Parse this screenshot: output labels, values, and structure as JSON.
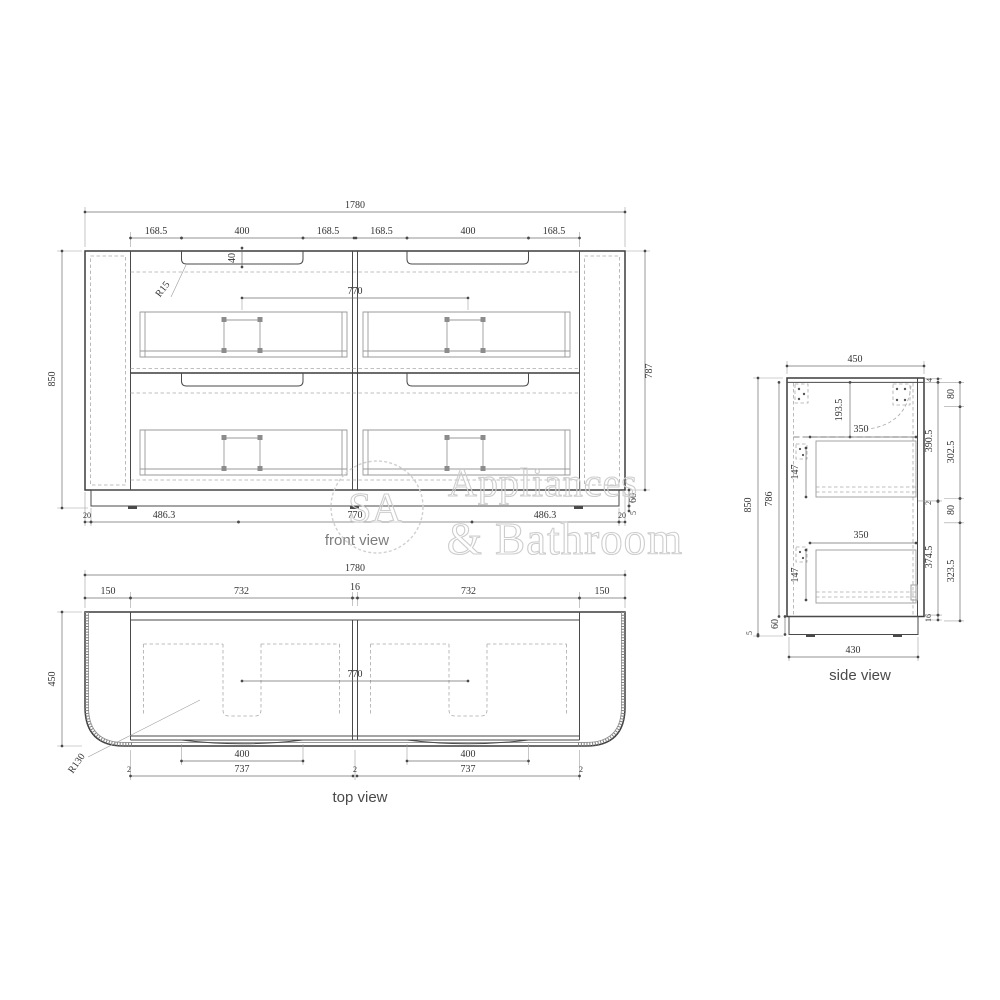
{
  "front_view": {
    "label": "front view",
    "overall_width": "1780",
    "segment_dims": [
      "168.5",
      "400",
      "168.5",
      "168.5",
      "400",
      "168.5"
    ],
    "recess_depth": "40",
    "recess_radius": "R15",
    "basin_spacing": "770",
    "overall_height": "850",
    "body_height": "787",
    "plinth_height": "60",
    "foot_height": "5",
    "bottom_dims": [
      "20",
      "486.3",
      "770",
      "486.3",
      "20"
    ]
  },
  "top_view": {
    "label": "top view",
    "overall_width": "1780",
    "segment_dims": [
      "150",
      "732",
      "16",
      "732",
      "150"
    ],
    "depth": "450",
    "basin_spacing": "770",
    "corner_radius": "R130",
    "recess_widths": [
      "400",
      "400"
    ],
    "bottom_dims": [
      "2",
      "737",
      "2",
      "737",
      "2"
    ]
  },
  "side_view": {
    "label": "side view",
    "depth": "450",
    "overall_height": "850",
    "body_height": "786",
    "top_inset": "193.5",
    "drawer_dims": {
      "top_depth": "350",
      "top_height": "147",
      "bottom_depth": "350",
      "bottom_height": "147"
    },
    "right_inner_dims": [
      "4",
      "390.5",
      "2",
      "374.5",
      "16"
    ],
    "right_outer_dims": [
      "80",
      "302.5",
      "80",
      "323.5"
    ],
    "plinth_height": "60",
    "foot_height": "5",
    "plinth_depth": "430"
  },
  "watermark": {
    "monogram": "SA",
    "line1": "Appliances",
    "line2": "& Bathroom"
  }
}
